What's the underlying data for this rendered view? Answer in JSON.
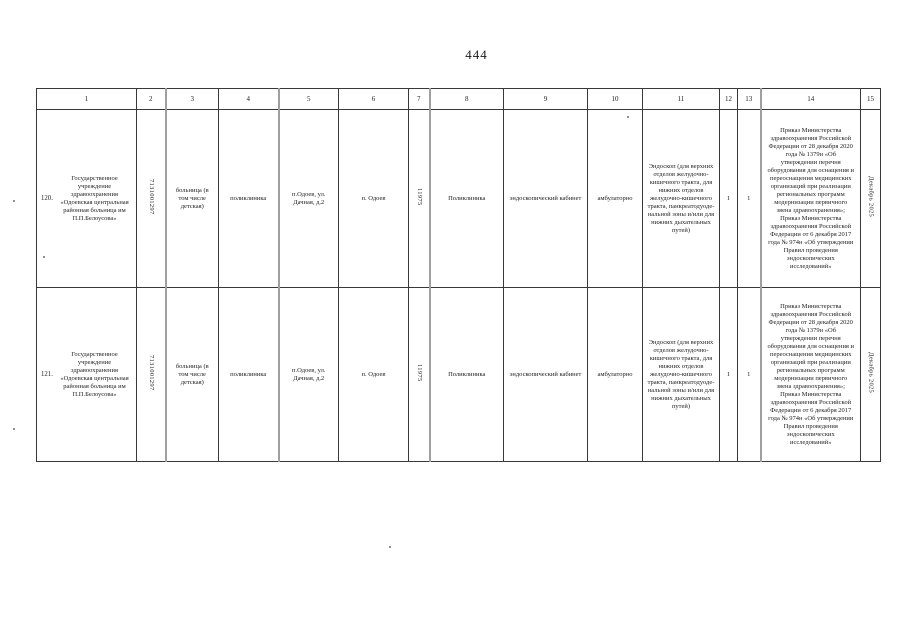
{
  "page": {
    "number": "444"
  },
  "table": {
    "headers": [
      "1",
      "2",
      "3",
      "4",
      "5",
      "6",
      "7",
      "8",
      "9",
      "10",
      "11",
      "12",
      "13",
      "14",
      "15"
    ],
    "rows": [
      {
        "num": "120.",
        "organization": "Государственное учреждение здравоохранения «Одоевская центральная районная больница им П.П.Белоусова»",
        "inn": "7131001297",
        "facility_type": "больница (в том числе детская)",
        "subdivision": "поликлиника",
        "address": "п.Одоев, ул. Дачная, д.2",
        "settlement": "п. Одоев",
        "population": "11975",
        "building": "Поликлиника",
        "cabinet": "эндоскопический кабинет",
        "care_conditions": "амбулаторно",
        "equipment": "Эндоскоп (для верхних отделов желудочно-кишечного тракта, для нижних отделов желудочно-кишечного тракта, панкреатодуоде-нальной зоны и/или для нижних дыхательных путей)",
        "qty_plan": "1",
        "qty_fact": "1",
        "legal_basis": "Приказ Министерства здравоохранения Российской Федерации от 28 декабря 2020 года № 1379н «Об утверждении перечня оборудования для оснащения и переоснащения медицинских организаций при реализации региональных программ модернизации первичного звена здравоохранения»; Приказ Министерства здравоохранения Российской Федерации от 6 декабря 2017 года № 974н «Об утверждении Правил проведения эндоскопических исследований»",
        "term": "Декабрь 2025"
      },
      {
        "num": "121.",
        "organization": "Государственное учреждение здравоохранения «Одоевская центральная районная больница им П.П.Белоусова»",
        "inn": "7131001297",
        "facility_type": "больница (в том числе детская)",
        "subdivision": "поликлиника",
        "address": "п.Одоев, ул. Дачная, д.2",
        "settlement": "п. Одоев",
        "population": "11975",
        "building": "Поликлиника",
        "cabinet": "эндоскопический кабинет",
        "care_conditions": "амбулаторно",
        "equipment": "Эндоскоп (для верхних отделов желудочно-кишечного тракта, для нижних отделов желудочно-кишечного тракта, панкреатодуоде-нальной зоны и/или для нижних дыхательных путей)",
        "qty_plan": "1",
        "qty_fact": "1",
        "legal_basis": "Приказ Министерства здравоохранения Российской Федерации от 28 декабря 2020 года № 1379н «Об утверждении перечня оборудования для оснащения и переоснащения медицинских организаций при реализации региональных программ модернизации первичного звена здравоохранения»; Приказ Министерства здравоохранения Российской Федерации от 6 декабря 2017 года № 974н «Об утверждении Правил проведения эндоскопических исследований»",
        "term": "Декабрь 2025"
      }
    ]
  }
}
